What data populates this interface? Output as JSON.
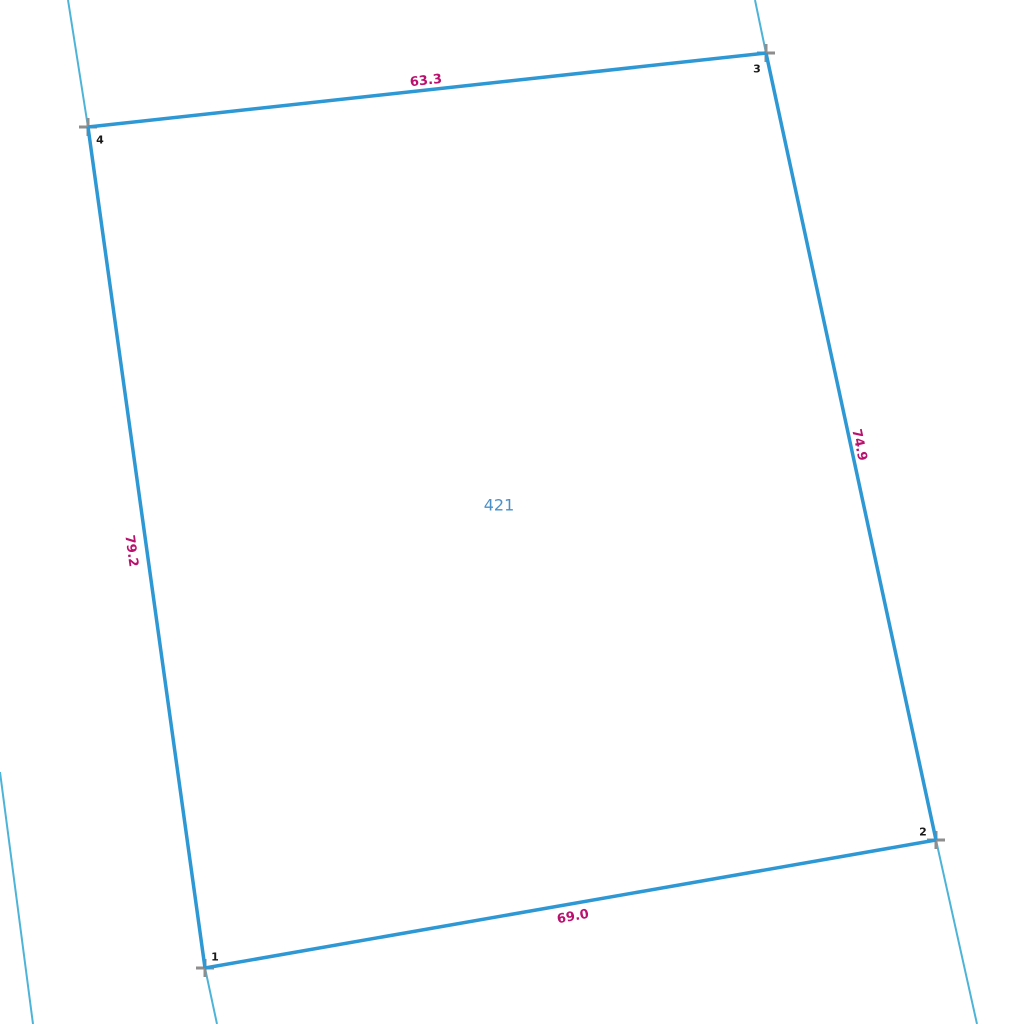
{
  "canvas": {
    "width": 1024,
    "height": 1024,
    "background": "#ffffff"
  },
  "colors": {
    "parcel_edge": "#2e98d4",
    "boundary_extension": "#4db4d8",
    "vertex_marker": "#8e8e8e",
    "dimension_label": "#bb116e",
    "vertex_number": "#1a1a1a",
    "parcel_number": "#4a90c8"
  },
  "parcel": {
    "number": "421",
    "number_pos": {
      "x": 499,
      "y": 505
    },
    "vertices": [
      {
        "id": "1",
        "x": 205,
        "y": 968,
        "label_pos": {
          "x": 215,
          "y": 957
        }
      },
      {
        "id": "2",
        "x": 936,
        "y": 840,
        "label_pos": {
          "x": 923,
          "y": 832
        }
      },
      {
        "id": "3",
        "x": 766,
        "y": 53,
        "label_pos": {
          "x": 757,
          "y": 69
        }
      },
      {
        "id": "4",
        "x": 88,
        "y": 127,
        "label_pos": {
          "x": 100,
          "y": 140
        }
      }
    ],
    "edges": [
      {
        "from": "4",
        "to": "3",
        "length": "63.3",
        "label_pos": {
          "x": 426,
          "y": 81
        },
        "label_angle": -6.2
      },
      {
        "from": "3",
        "to": "2",
        "length": "74.9",
        "label_pos": {
          "x": 859,
          "y": 445
        },
        "label_angle": 77.8
      },
      {
        "from": "1",
        "to": "2",
        "length": "69.0",
        "label_pos": {
          "x": 573,
          "y": 917
        },
        "label_angle": -9.9
      },
      {
        "from": "4",
        "to": "1",
        "length": "79.2",
        "label_pos": {
          "x": 131,
          "y": 551
        },
        "label_angle": 82.1
      }
    ]
  },
  "extension_lines": [
    {
      "x1": 68,
      "y1": 0,
      "x2": 88,
      "y2": 127
    },
    {
      "x1": 755,
      "y1": 0,
      "x2": 766,
      "y2": 53
    },
    {
      "x1": 205,
      "y1": 968,
      "x2": 217,
      "y2": 1024
    },
    {
      "x1": 936,
      "y1": 840,
      "x2": 977,
      "y2": 1024
    },
    {
      "x1": 0,
      "y1": 772,
      "x2": 33,
      "y2": 1024
    }
  ],
  "marker": {
    "half_size": 9,
    "stroke_width": 3
  }
}
